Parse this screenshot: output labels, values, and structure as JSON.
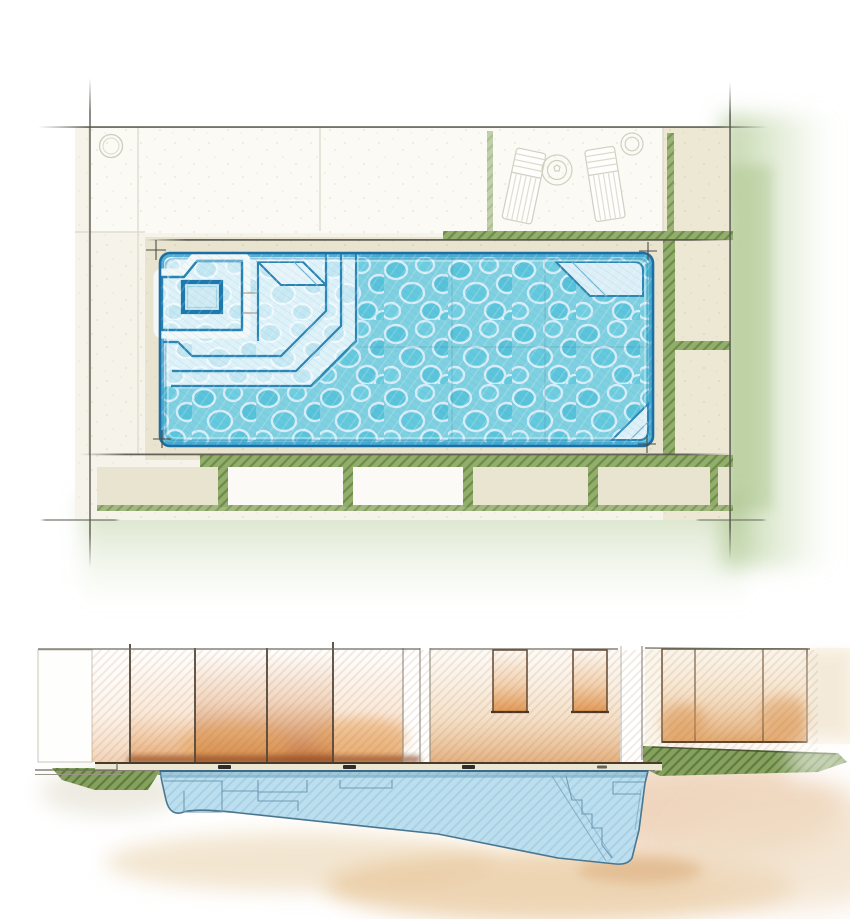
{
  "illustration": {
    "type": "pool-design-rendering",
    "views": {
      "top": "plan-view",
      "bottom": "section-view"
    }
  },
  "palette": {
    "paper": "#ffffff",
    "sketch_line": "#56554b",
    "deck_beige": "#e9e4cf",
    "deck_light": "#f6f4ea",
    "paver_white": "#fcfcf8",
    "grass_joint": "#93ad6d",
    "grass_hatch": "#6e8c49",
    "grass_wash": "#a9c389",
    "pool_border": "#1d6fa3",
    "pool_rim": "#3ea5cf",
    "water_base": "#7fd0e0",
    "water_cell": "#5ac4da",
    "water_crack": "#d6ecf8",
    "shallow_base": "#dff2f9",
    "shallow_cell": "#c3e7f2",
    "bench_fill": "#dceff7",
    "fence_orange": "#d98a4a",
    "fence_orange_deep": "#a84f22",
    "fence_tan": "#f0dcc0",
    "fence_line": "#5f4632",
    "section_water": "#bcdfef",
    "section_line": "#49758e",
    "soil_tan": "#e8c79b",
    "ground_line": "#4a3a2c"
  },
  "inventory": {
    "lounge_chairs": 2,
    "round_side_table": 1,
    "deck_circles": 2,
    "tanning_ledge": 1,
    "spa_box": 1,
    "plan_step_edges": 3,
    "corner_benches": 2,
    "bottom_paver_count": 5,
    "fence_windows": 2,
    "fence_posts": 5,
    "waterline_fittings": 3
  }
}
